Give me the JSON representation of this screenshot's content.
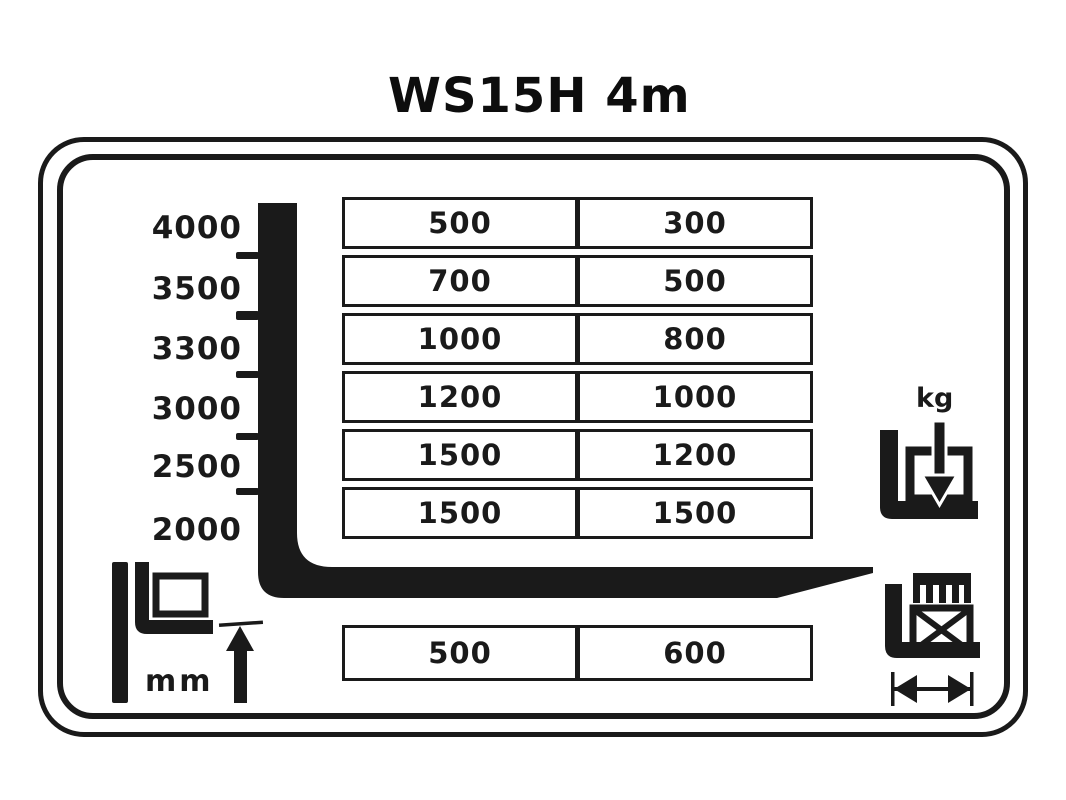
{
  "title": "WS15H 4m",
  "colors": {
    "ink": "#1a1a1a",
    "background": "#ffffff"
  },
  "height_scale": {
    "unit": "mm",
    "values": [
      "4000",
      "3500",
      "3300",
      "3000",
      "2500",
      "2000"
    ]
  },
  "capacity_table": {
    "unit": "kg",
    "rows": [
      {
        "c1": "500",
        "c2": "300"
      },
      {
        "c1": "700",
        "c2": "500"
      },
      {
        "c1": "1000",
        "c2": "800"
      },
      {
        "c1": "1200",
        "c2": "1000"
      },
      {
        "c1": "1500",
        "c2": "1200"
      },
      {
        "c1": "1500",
        "c2": "1500"
      }
    ]
  },
  "load_center_table": {
    "unit": "mm",
    "row": {
      "c1": "500",
      "c2": "600"
    }
  },
  "icons": {
    "lift_height_label": "mm",
    "capacity_label": "kg"
  }
}
